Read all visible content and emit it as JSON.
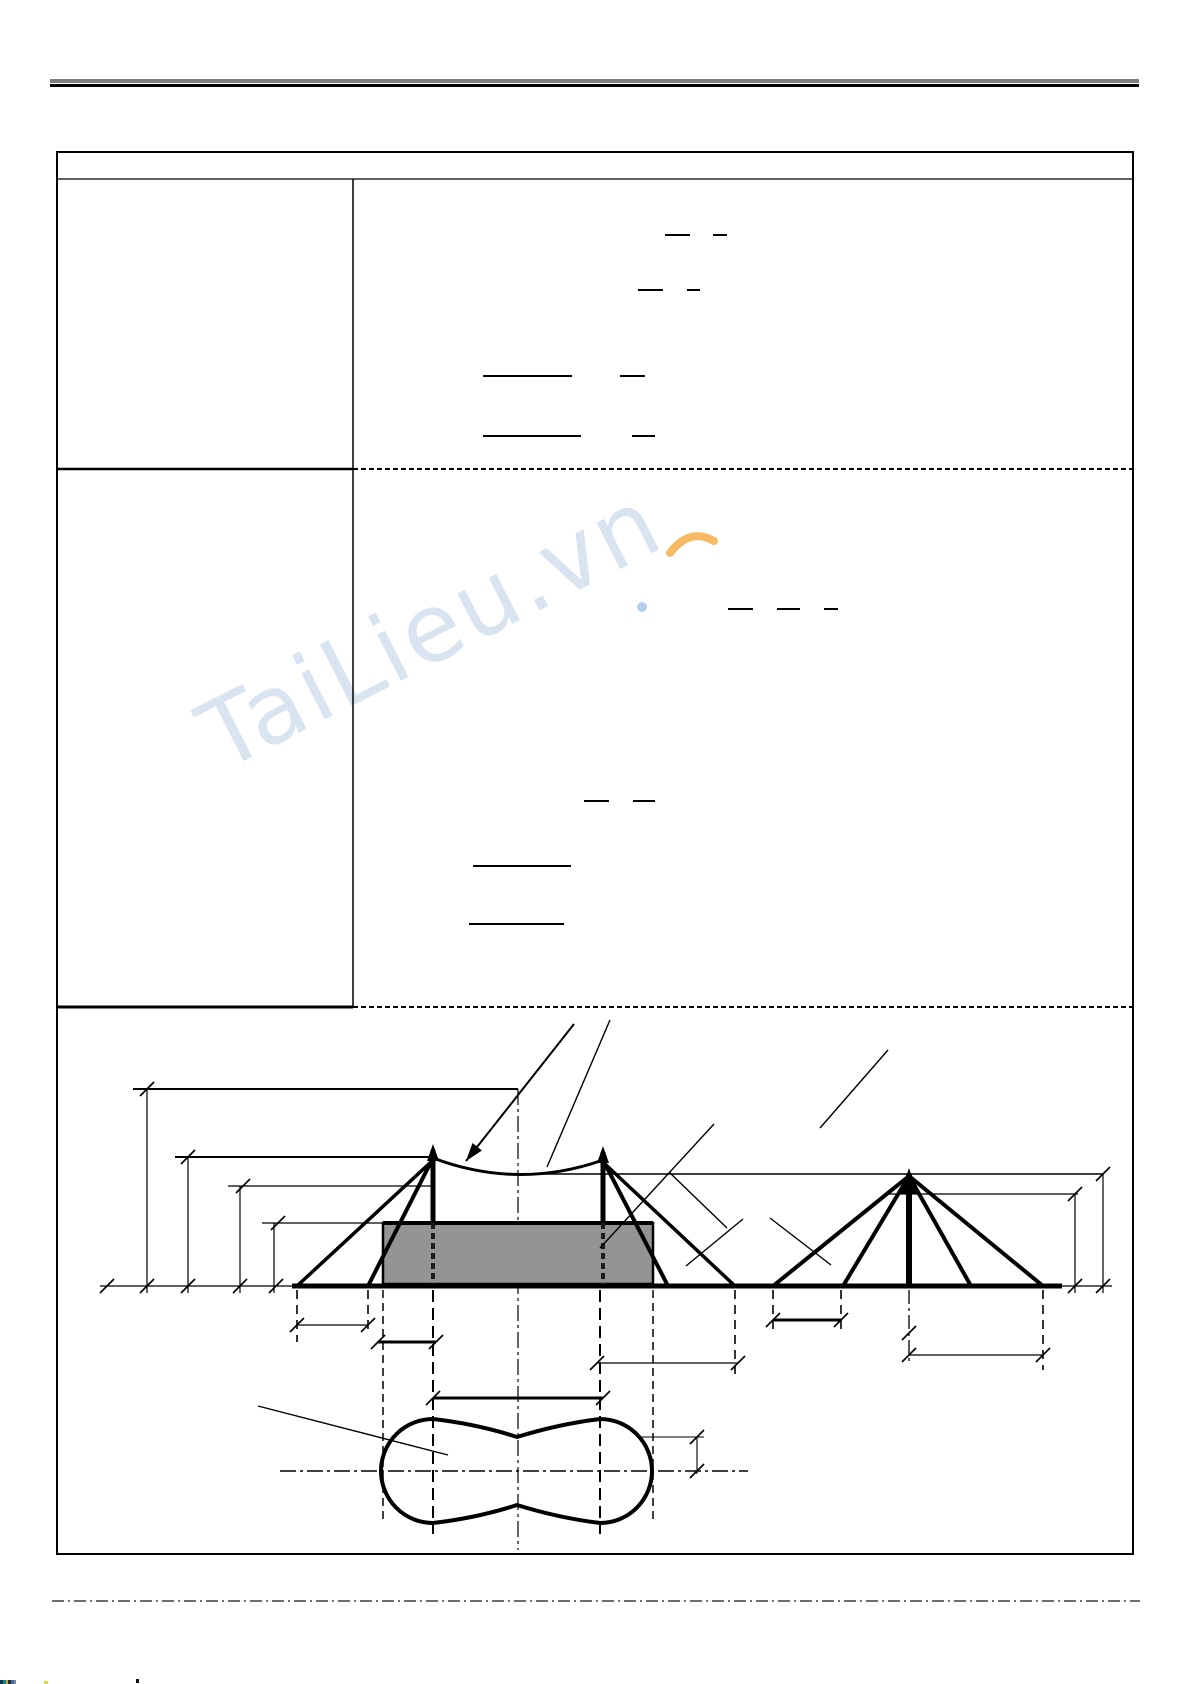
{
  "page": {
    "width_px": 1192,
    "height_px": 1684,
    "background": "#ffffff"
  },
  "header_rule": {
    "gray": "#7d7d7d",
    "black": "#000000"
  },
  "watermark": {
    "text": "TaiLieu.vn",
    "text_color": "#b5cae5",
    "dot_color": "#85aede",
    "accent_color": "#f6a83c"
  },
  "figure": {
    "tent_fill": "#949494",
    "line_color": "#000000"
  },
  "footer": {
    "dashdot_color": "#3f3f3f"
  },
  "formula_bars": [
    {
      "x": 665,
      "y": 235,
      "w": 25
    },
    {
      "x": 713,
      "y": 235,
      "w": 14
    },
    {
      "x": 638,
      "y": 290,
      "w": 25
    },
    {
      "x": 687,
      "y": 290,
      "w": 13
    },
    {
      "x": 483,
      "y": 376,
      "w": 89
    },
    {
      "x": 620,
      "y": 376,
      "w": 25
    },
    {
      "x": 483,
      "y": 436,
      "w": 98
    },
    {
      "x": 632,
      "y": 436,
      "w": 23
    },
    {
      "x": 728,
      "y": 609,
      "w": 25
    },
    {
      "x": 777,
      "y": 609,
      "w": 23
    },
    {
      "x": 824,
      "y": 609,
      "w": 14
    },
    {
      "x": 584,
      "y": 801,
      "w": 25
    },
    {
      "x": 633,
      "y": 801,
      "w": 22
    },
    {
      "x": 473,
      "y": 866,
      "w": 98
    },
    {
      "x": 469,
      "y": 924,
      "w": 95
    }
  ]
}
